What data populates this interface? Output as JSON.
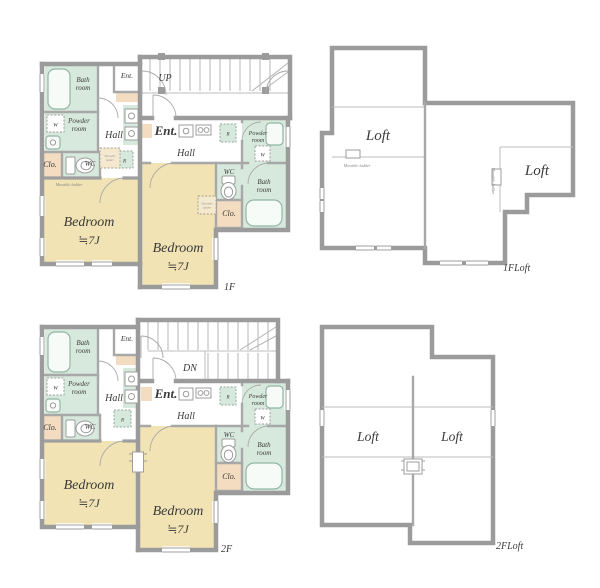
{
  "colors": {
    "wall": "#9b9b9b",
    "room_green": "#d7e9dd",
    "room_tan": "#f3dcbf",
    "room_yellow": "#f1e3b4",
    "text": "#3a3a3a"
  },
  "f1": {
    "floor_label": "1F",
    "stairs_label": "UP",
    "unit_a": {
      "bath": [
        "Bath",
        "room"
      ],
      "powder": [
        "Powder",
        "room"
      ],
      "ent": "Ent.",
      "hall": "Hall",
      "clo": "Clo.",
      "wc": "WC",
      "washer": "W",
      "fridge": "R",
      "ladder_note": "Movable ladder",
      "ladder_box": [
        "Movable",
        "ladder"
      ],
      "bedroom": [
        "Bedroom",
        "≒7J"
      ]
    },
    "unit_b": {
      "ent": "Ent.",
      "hall": "Hall",
      "powder": [
        "Powder",
        "room"
      ],
      "wc": "WC",
      "bath": [
        "Bath",
        "room"
      ],
      "clo": "Clo.",
      "washer": "W",
      "fridge": "R",
      "ladder_box": [
        "Movable",
        "ladder"
      ],
      "bedroom": [
        "Bedroom",
        "≒7J"
      ]
    }
  },
  "f1loft": {
    "floor_label": "1FLoft",
    "loft_left": "Loft",
    "loft_right": "Loft",
    "ladder_left": "Movable ladder",
    "ladder_right": "Movable ladder"
  },
  "f2": {
    "floor_label": "2F",
    "stairs_label": "DN",
    "unit_a": {
      "bath": [
        "Bath",
        "room"
      ],
      "powder": [
        "Powder",
        "room"
      ],
      "ent": "Ent.",
      "hall": "Hall",
      "clo": "Clo.",
      "wc": "WC",
      "washer": "W",
      "fridge": "R",
      "bedroom": [
        "Bedroom",
        "≒7J"
      ]
    },
    "unit_b": {
      "ent": "Ent.",
      "hall": "Hall",
      "powder": [
        "Powder",
        "room"
      ],
      "wc": "WC",
      "bath": [
        "Bath",
        "room"
      ],
      "clo": "Clo.",
      "washer": "W",
      "fridge": "R",
      "bedroom": [
        "Bedroom",
        "≒7J"
      ]
    }
  },
  "f2loft": {
    "floor_label": "2FLoft",
    "loft_left": "Loft",
    "loft_right": "Loft"
  }
}
